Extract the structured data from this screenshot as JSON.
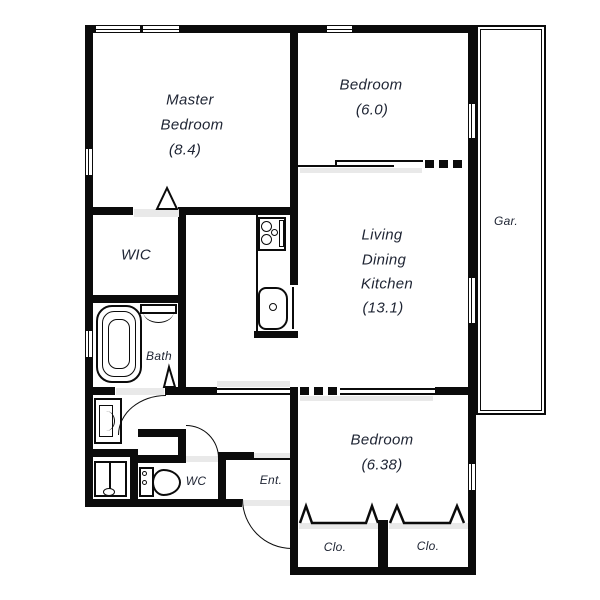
{
  "colors": {
    "wall": "#0b0b0b",
    "text": "#1e2433",
    "shade": "#e9e9e9",
    "background": "#ffffff"
  },
  "rooms": {
    "master_bedroom": {
      "name_line1": "Master",
      "name_line2": "Bedroom",
      "area": "(8.4)"
    },
    "bedroom_top": {
      "name": "Bedroom",
      "area": "(6.0)"
    },
    "living_dining_kitchen": {
      "name_line1": "Living",
      "name_line2": "Dining",
      "name_line3": "Kitchen",
      "area": "(13.1)"
    },
    "bedroom_bottom": {
      "name": "Bedroom",
      "area": "(6.38)"
    },
    "walk_in_closet": {
      "name": "WIC"
    },
    "bathroom": {
      "name": "Bath"
    },
    "toilet_room": {
      "name": "WC"
    },
    "entrance": {
      "name": "Ent."
    },
    "garden_terrace": {
      "name": "Gar."
    },
    "closet_left": {
      "name": "Clo."
    },
    "closet_right": {
      "name": "Clo."
    }
  }
}
